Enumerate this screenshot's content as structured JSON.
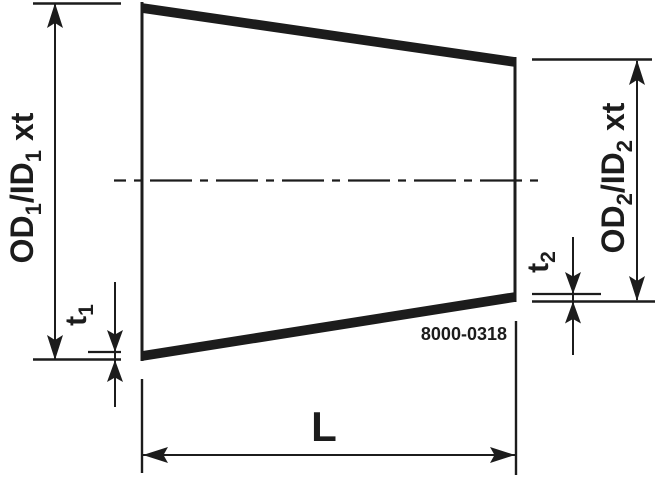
{
  "diagram": {
    "part_number": "8000-0318",
    "labels": {
      "od1": {
        "p1": "OD",
        "s1": "1",
        "p2": "/ID",
        "s2": "1",
        "p3": "xt",
        "full": "OD₁/ID₁ xt"
      },
      "od2": {
        "p1": "OD",
        "s1": "2",
        "p2": "/ID",
        "s2": "2",
        "p3": "xt",
        "full": "OD₂/ID₂ xt"
      },
      "t1": {
        "p": "t",
        "s": "1",
        "full": "t₁"
      },
      "t2": {
        "p": "t",
        "s": "2",
        "full": "t₂"
      },
      "length": "L"
    },
    "colors": {
      "line": "#1c1c1c",
      "background": "#ffffff"
    }
  }
}
